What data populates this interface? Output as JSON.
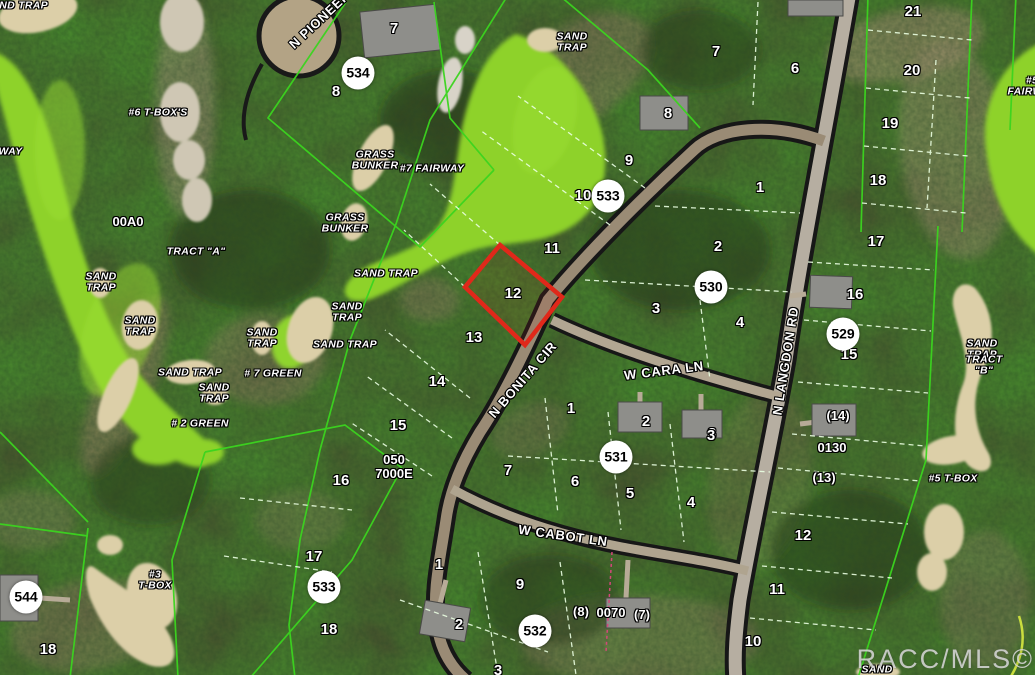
{
  "map": {
    "watermark": "RACC/MLS©",
    "highlighted_parcel": {
      "lot": "12",
      "outline_color": "#e0281a",
      "points": "500,245 562,297 525,345 465,287"
    },
    "colors": {
      "lot_line_green": "#3bd41f",
      "interior_line_pale": "#eaffe2",
      "fairway_green": "#8ed22b",
      "sand_tan": "#dccfa8",
      "road_casing_black": "#171717"
    },
    "lot_numbers": [
      {
        "t": "7",
        "x": 394,
        "y": 29
      },
      {
        "t": "8",
        "x": 336,
        "y": 92
      },
      {
        "t": "8",
        "x": 668,
        "y": 114
      },
      {
        "t": "9",
        "x": 629,
        "y": 161
      },
      {
        "t": "10",
        "x": 583,
        "y": 196
      },
      {
        "t": "11",
        "x": 552,
        "y": 249
      },
      {
        "t": "12",
        "x": 513,
        "y": 294
      },
      {
        "t": "13",
        "x": 474,
        "y": 338
      },
      {
        "t": "14",
        "x": 437,
        "y": 382
      },
      {
        "t": "15",
        "x": 398,
        "y": 426
      },
      {
        "t": "16",
        "x": 341,
        "y": 481
      },
      {
        "t": "17",
        "x": 314,
        "y": 557
      },
      {
        "t": "18",
        "x": 329,
        "y": 630
      },
      {
        "t": "18",
        "x": 48,
        "y": 650
      },
      {
        "t": "7",
        "x": 716,
        "y": 52
      },
      {
        "t": "6",
        "x": 795,
        "y": 69
      },
      {
        "t": "21",
        "x": 913,
        "y": 12
      },
      {
        "t": "20",
        "x": 912,
        "y": 71
      },
      {
        "t": "19",
        "x": 890,
        "y": 124
      },
      {
        "t": "18",
        "x": 878,
        "y": 181
      },
      {
        "t": "1",
        "x": 760,
        "y": 188
      },
      {
        "t": "2",
        "x": 718,
        "y": 247
      },
      {
        "t": "3",
        "x": 656,
        "y": 309
      },
      {
        "t": "4",
        "x": 740,
        "y": 323
      },
      {
        "t": "17",
        "x": 876,
        "y": 242
      },
      {
        "t": "16",
        "x": 855,
        "y": 295
      },
      {
        "t": "15",
        "x": 849,
        "y": 355
      },
      {
        "t": "3",
        "x": 712,
        "y": 434
      },
      {
        "t": "12",
        "x": 803,
        "y": 536
      },
      {
        "t": "11",
        "x": 777,
        "y": 590
      },
      {
        "t": "10",
        "x": 753,
        "y": 642
      },
      {
        "t": "1",
        "x": 571,
        "y": 409
      },
      {
        "t": "2",
        "x": 646,
        "y": 422
      },
      {
        "t": "3",
        "x": 711,
        "y": 436
      },
      {
        "t": "7",
        "x": 508,
        "y": 471
      },
      {
        "t": "6",
        "x": 575,
        "y": 482
      },
      {
        "t": "5",
        "x": 630,
        "y": 494
      },
      {
        "t": "4",
        "x": 691,
        "y": 503
      },
      {
        "t": "1",
        "x": 439,
        "y": 565
      },
      {
        "t": "9",
        "x": 520,
        "y": 585
      },
      {
        "t": "2",
        "x": 459,
        "y": 625
      },
      {
        "t": "3",
        "x": 498,
        "y": 671
      }
    ],
    "parcel_codes": [
      {
        "t": "00A0",
        "x": 128,
        "y": 222
      },
      {
        "t": "050\n7000E",
        "x": 394,
        "y": 467
      },
      {
        "t": "0130",
        "x": 832,
        "y": 448
      },
      {
        "t": "(14)",
        "x": 838,
        "y": 416
      },
      {
        "t": "(13)",
        "x": 824,
        "y": 478
      },
      {
        "t": "(8)",
        "x": 581,
        "y": 612
      },
      {
        "t": "0070",
        "x": 611,
        "y": 613
      },
      {
        "t": "(7)",
        "x": 642,
        "y": 615
      }
    ],
    "address_bubbles": [
      {
        "t": "534",
        "x": 358,
        "y": 73
      },
      {
        "t": "533",
        "x": 608,
        "y": 196
      },
      {
        "t": "530",
        "x": 711,
        "y": 287
      },
      {
        "t": "529",
        "x": 843,
        "y": 334
      },
      {
        "t": "531",
        "x": 616,
        "y": 457
      },
      {
        "t": "532",
        "x": 535,
        "y": 631
      },
      {
        "t": "533",
        "x": 324,
        "y": 587
      },
      {
        "t": "544",
        "x": 26,
        "y": 597
      }
    ],
    "road_labels": [
      {
        "t": "N PIONEER",
        "x": 320,
        "y": 20,
        "r": -43
      },
      {
        "t": "N BONITA CIR",
        "x": 523,
        "y": 380,
        "r": -49
      },
      {
        "t": "W CARA LN",
        "x": 664,
        "y": 371,
        "r": -7
      },
      {
        "t": "N LANGDON RD",
        "x": 786,
        "y": 361,
        "r": -81
      },
      {
        "t": "W CABOT LN",
        "x": 563,
        "y": 536,
        "r": 8
      }
    ],
    "golf_labels": [
      {
        "t": "SAND TRAP",
        "x": 16,
        "y": 6
      },
      {
        "t": "#6 T-BOX'S",
        "x": 158,
        "y": 113
      },
      {
        "t": "FAIRWAY",
        "x": -2,
        "y": 152
      },
      {
        "t": "TRACT \"A\"",
        "x": 196,
        "y": 252
      },
      {
        "t": "SAND\nTRAP",
        "x": 101,
        "y": 283
      },
      {
        "t": "SAND\nTRAP",
        "x": 140,
        "y": 327
      },
      {
        "t": "SAND TRAP",
        "x": 190,
        "y": 373
      },
      {
        "t": "SAND\nTRAP",
        "x": 214,
        "y": 394
      },
      {
        "t": "SAND\nTRAP",
        "x": 262,
        "y": 339
      },
      {
        "t": "# 7 GREEN",
        "x": 273,
        "y": 374
      },
      {
        "t": "SAND TRAP",
        "x": 345,
        "y": 345
      },
      {
        "t": "# 2 GREEN",
        "x": 200,
        "y": 424
      },
      {
        "t": "GRASS\nBUNKER",
        "x": 375,
        "y": 161
      },
      {
        "t": "#7 FAIRWAY",
        "x": 432,
        "y": 169
      },
      {
        "t": "GRASS\nBUNKER",
        "x": 345,
        "y": 224
      },
      {
        "t": "SAND\nTRAP",
        "x": 572,
        "y": 43
      },
      {
        "t": "SAND TRAP",
        "x": 386,
        "y": 274
      },
      {
        "t": "SAND\nTRAP",
        "x": 347,
        "y": 313
      },
      {
        "t": "SAND\nTRAP",
        "x": 982,
        "y": 350
      },
      {
        "t": "TRACT \"B\"",
        "x": 984,
        "y": 366
      },
      {
        "t": "#5 T-BOX",
        "x": 953,
        "y": 479
      },
      {
        "t": "#3\nT-BOX",
        "x": 155,
        "y": 581
      },
      {
        "t": "#5 FAIRWAY",
        "x": 1032,
        "y": 87
      },
      {
        "t": "SAND",
        "x": 877,
        "y": 670
      }
    ]
  }
}
